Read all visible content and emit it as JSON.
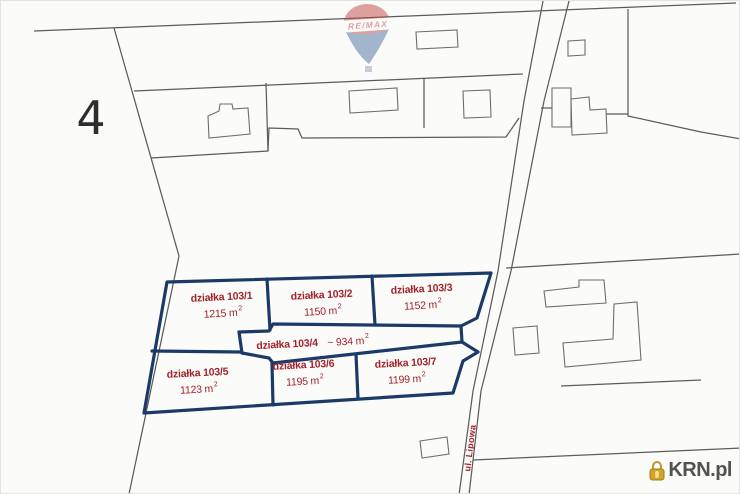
{
  "watermark": {
    "brand": "RE/MAX"
  },
  "credit": {
    "site": "KRN.pl"
  },
  "map": {
    "district_number": "4",
    "street": "ul. Lipowa",
    "colors": {
      "plot_outline": "#1c3a68",
      "label_red": "#a1222a",
      "cadastral_line": "#5c5c5c"
    },
    "plots": [
      {
        "label": "działka 103/1",
        "area": "1215 m",
        "exp": "2"
      },
      {
        "label": "działka 103/2",
        "area": "1150 m",
        "exp": "2"
      },
      {
        "label": "działka 103/3",
        "area": "1152 m",
        "exp": "2"
      },
      {
        "label": "działka 103/4",
        "area": "~ 934 m",
        "exp": "2"
      },
      {
        "label": "działka 103/5",
        "area": "1123 m",
        "exp": "2"
      },
      {
        "label": "działka 103/6",
        "area": "1195 m",
        "exp": "2"
      },
      {
        "label": "działka 103/7",
        "area": "1199 m",
        "exp": "2"
      }
    ]
  }
}
